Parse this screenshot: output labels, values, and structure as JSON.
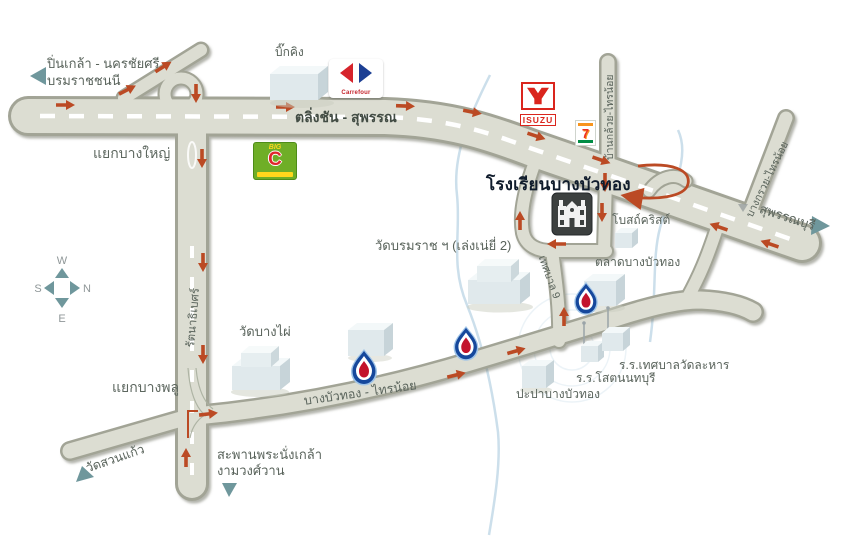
{
  "compass": {
    "top": "W",
    "left": "S",
    "right": "N",
    "bottom": "E"
  },
  "roads": {
    "taling_chan_suphan": "ตลิ่งชัน - สุพรรณ",
    "ban_kluai_sai_noi": "บ้านกล้วย-ไทรน้อย",
    "bang_kruai_sai_noi": "บางกรวย-ไทรน้อย",
    "rattanathibet": "รัตนาธิเบศร์",
    "bang_bua_thong_sai_noi": "บางบัวทอง - ไทรน้อย",
    "thetsaban_9": "เทศบาล 9"
  },
  "junctions": {
    "bang_yai": "แยกบางใหญ่",
    "bang_phlu": "แยกบางพลู"
  },
  "destinations": {
    "pin_klao": "ปิ่นเกล้า - นครชัยศรี",
    "borommaratchachonnani": "บรมราชชนนี",
    "suphan_buri": "สุพรรณบุรี",
    "saphan_phra_nangklao": "สะพานพระนั่งเกล้า",
    "ngam_wong_wan": "งามวงศ์วาน",
    "wat_suan_kaeo": "วัดสวนแก้ว"
  },
  "places": {
    "school": "โรงเรียนบางบัวทอง",
    "big_king": "บิ๊กคิง",
    "church": "โบสถ์คริสต์",
    "market": "ตลาดบางบัวทอง",
    "wat_borommaracha": "วัดบรมราช ฯ (เล่งเน่ยี่ 2)",
    "wat_bang_phai": "วัดบางไผ่",
    "waterworks": "ปะปาบางบัวทอง",
    "school_sot_nonthaburi": "ร.ร.โสตนนทบุรี",
    "school_thetsaban_wat_lahan": "ร.ร.เทศบาลวัดละหาร"
  },
  "logos": {
    "carrefour": "Carrefour",
    "isuzu": "ISUZU",
    "seven_eleven": "7",
    "big_c_top": "BIG",
    "big_c_letter": "C"
  },
  "colors": {
    "road_fill": "#dcddd2",
    "road_border": "#a2a496",
    "arrow_red": "#bb4a24",
    "label_gray": "#59635b",
    "teal_pointer": "#6f979c",
    "canal_blue": "#c3d9e8",
    "school_title": "#101c2c",
    "ptt_blue": "#16489c",
    "ptt_red": "#c3132c"
  }
}
